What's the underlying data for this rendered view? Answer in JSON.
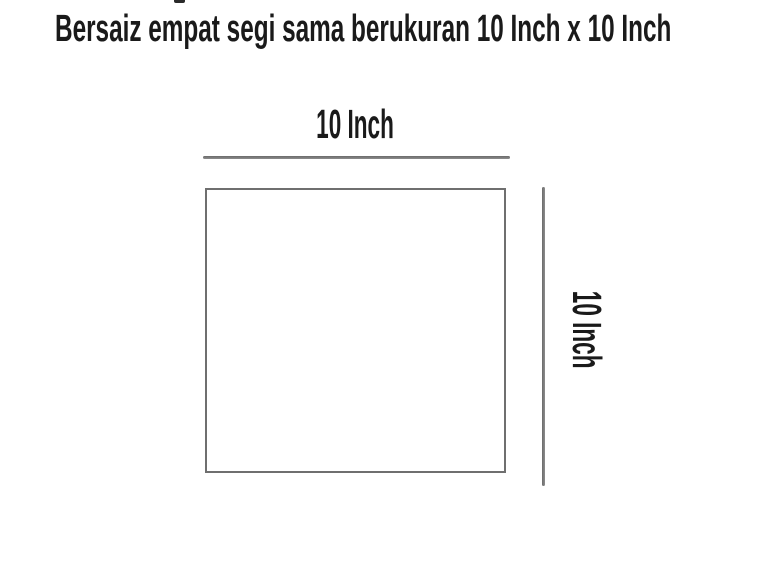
{
  "title": {
    "text": "Bersaiz empat segi sama berukuran 10 Inch x 10 Inch"
  },
  "diagram": {
    "shape": "square",
    "top_dimension": {
      "label": "10 Inch"
    },
    "right_dimension": {
      "label": "10 Inch"
    }
  },
  "colors": {
    "text_color": "#1a1a1a",
    "line_color": "#7b7b7b",
    "border_color": "#6f6f6f",
    "bg_color": "#ffffff"
  }
}
